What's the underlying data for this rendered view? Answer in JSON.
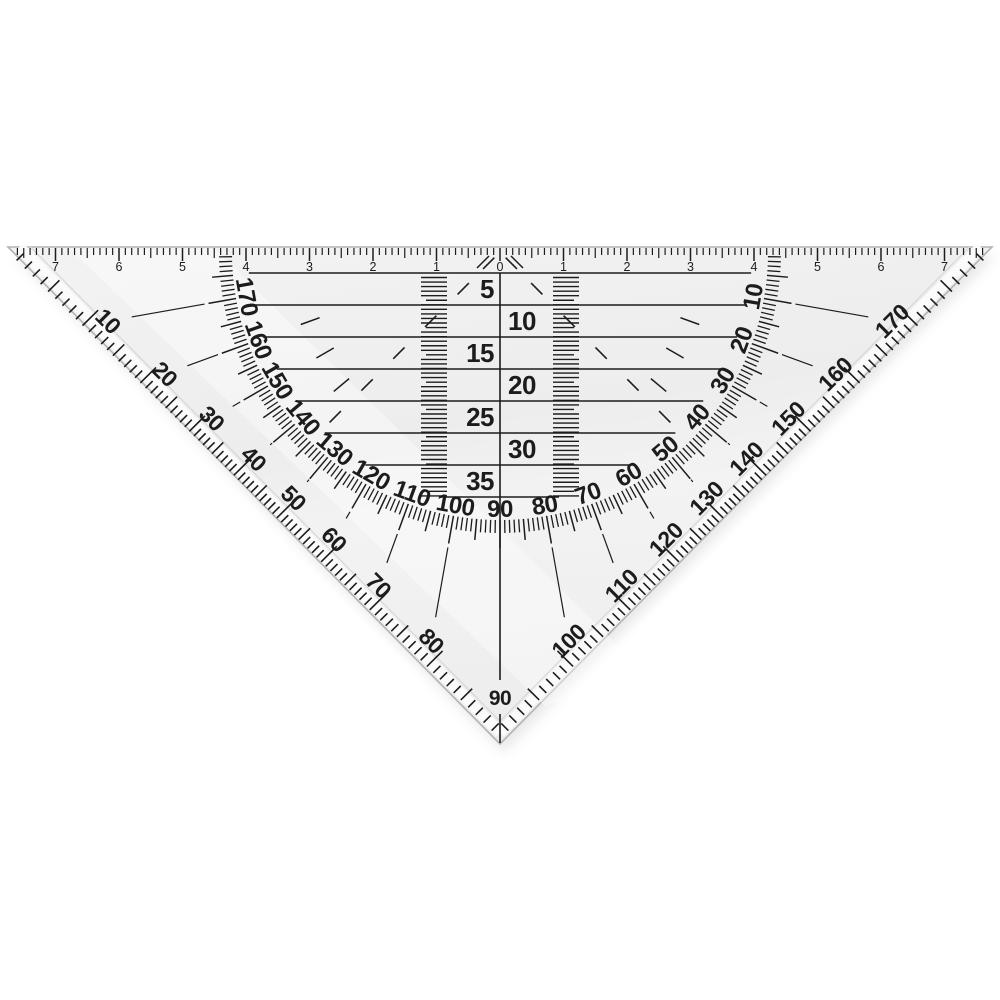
{
  "scene": {
    "description": "transparent triangular protractor set square on white background"
  },
  "colors": {
    "background": "#ffffff",
    "ink": "#1c1c1c",
    "body": "#f3f3f3",
    "body_dark": "#ededee",
    "bevel_highlight": "#fbfbfb",
    "bevel_line": "#d7d7d7",
    "edge_line": "#b3b3b3",
    "shadow": "rgba(0,0,0,0.09)",
    "sheen": "rgba(255,255,255,0.38)"
  },
  "top_ruler": {
    "zero_label": "0",
    "cm_labels": [
      "1",
      "2",
      "3",
      "4",
      "5",
      "6",
      "7"
    ]
  },
  "mm_scale": {
    "labels": [
      "5",
      "10",
      "15",
      "20",
      "25",
      "30",
      "35"
    ]
  },
  "protractor": {
    "inner_arc_labels": [
      "10",
      "20",
      "30",
      "40",
      "50",
      "60",
      "70",
      "80",
      "90",
      "100",
      "110",
      "120",
      "130",
      "140",
      "150",
      "160",
      "170"
    ],
    "edge_labels_left": [
      "10",
      "20",
      "30",
      "40",
      "50",
      "60",
      "70",
      "80"
    ],
    "apex_label": "90",
    "edge_labels_right": [
      "100",
      "110",
      "120",
      "130",
      "140",
      "150",
      "160",
      "170"
    ]
  }
}
